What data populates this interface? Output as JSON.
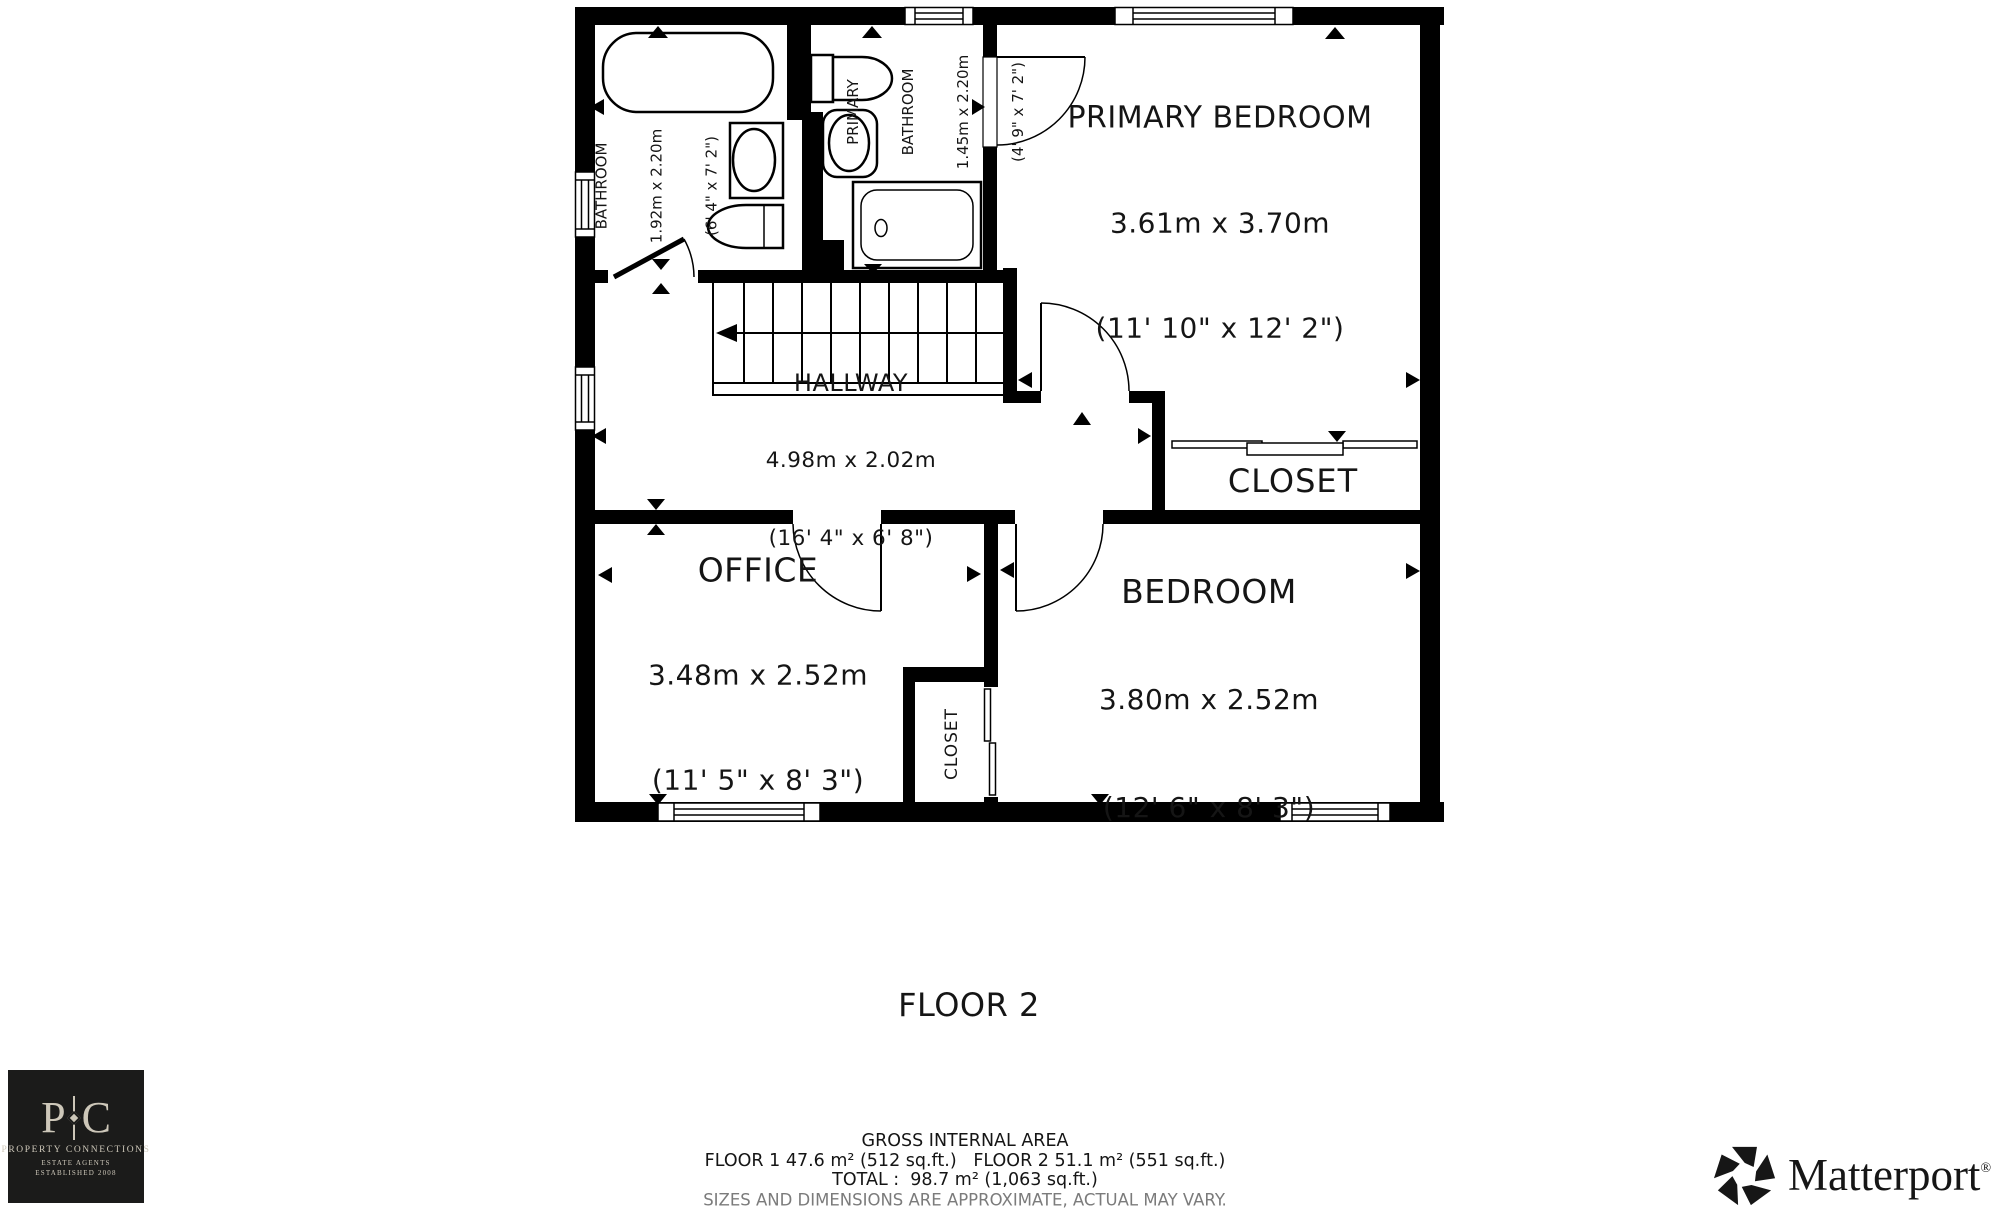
{
  "plan": {
    "floor_label": "FLOOR 2",
    "rooms": {
      "primary_bedroom": {
        "name": "PRIMARY BEDROOM",
        "dim_m": "3.61m x 3.70m",
        "dim_ft": "(11' 10\" x 12' 2\")"
      },
      "hallway": {
        "name": "HALLWAY",
        "dim_m": "4.98m x 2.02m",
        "dim_ft": "(16' 4\" x 6' 8\")"
      },
      "office": {
        "name": "OFFICE",
        "dim_m": "3.48m x 2.52m",
        "dim_ft": "(11' 5\" x 8' 3\")"
      },
      "bedroom": {
        "name": "BEDROOM",
        "dim_m": "3.80m x 2.52m",
        "dim_ft": "(12' 6\" x 8' 3\")"
      },
      "closet_main": {
        "name": "CLOSET"
      },
      "closet_small": {
        "name": "CLOSET"
      },
      "bathroom": {
        "name": "BATHROOM",
        "dim_m": "1.92m x 2.20m",
        "dim_ft": "(6' 4\" x 7' 2\")"
      },
      "primary_bathroom": {
        "name_line1": "PRIMARY",
        "name_line2": "BATHROOM",
        "dim_m": "1.45m x 2.20m",
        "dim_ft": "(4' 9\" x 7' 2\")"
      }
    }
  },
  "footer": {
    "gross_title": "GROSS INTERNAL AREA",
    "floors_line": "FLOOR 1 47.6 m² (512 sq.ft.)   FLOOR 2 51.1 m² (551 sq.ft.)",
    "total_line": "TOTAL :  98.7 m² (1,063 sq.ft.)",
    "disclaimer": "SIZES AND DIMENSIONS ARE APPROXIMATE, ACTUAL MAY VARY."
  },
  "logos": {
    "pc": {
      "letter_left": "P",
      "letter_right": "C",
      "name": "PROPERTY CONNECTIONS",
      "sub1": "ESTATE AGENTS",
      "sub2": "ESTABLISHED 2008"
    },
    "matterport": {
      "name": "Matterport",
      "reg": "®"
    }
  },
  "colors": {
    "ink": "#000000",
    "disclaimer_gray": "#7b7b7b",
    "pc_background": "#1b1b1a",
    "pc_foreground": "#cdc7b9"
  }
}
